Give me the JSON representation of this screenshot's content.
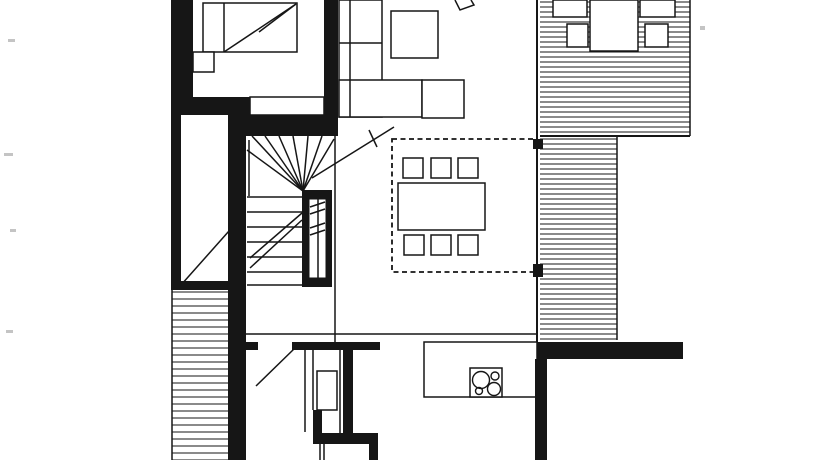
{
  "canvas": {
    "width": 840,
    "height": 460,
    "bg": "#ffffff",
    "ink": "#161616",
    "speck": "#c4c4c4"
  },
  "plan": {
    "hatches": [
      {
        "name": "deck-upper-hatch",
        "x": 540,
        "y": 0,
        "w": 150,
        "h": 134,
        "spacing": 5
      },
      {
        "name": "deck-strip-hatch",
        "x": 540,
        "y": 137,
        "w": 77,
        "h": 203,
        "spacing": 5
      },
      {
        "name": "deck-left-hatch",
        "x": 172,
        "y": 290,
        "w": 56,
        "h": 170,
        "spacing": 7
      }
    ],
    "furniture": [
      {
        "name": "deck-table",
        "x": 590,
        "y": 0,
        "w": 48,
        "h": 51
      },
      {
        "name": "deck-chair",
        "x": 553,
        "y": 0,
        "w": 34,
        "h": 17
      },
      {
        "name": "deck-chair",
        "x": 567,
        "y": 24,
        "w": 21,
        "h": 23
      },
      {
        "name": "deck-chair",
        "x": 640,
        "y": 0,
        "w": 35,
        "h": 17
      },
      {
        "name": "deck-chair",
        "x": 645,
        "y": 24,
        "w": 23,
        "h": 23
      },
      {
        "name": "bed",
        "x": 203,
        "y": 3,
        "w": 94,
        "h": 49
      },
      {
        "name": "nightstand",
        "x": 193,
        "y": 52,
        "w": 21,
        "h": 20
      },
      {
        "name": "wardrobe",
        "x": 250,
        "y": 97,
        "w": 74,
        "h": 18
      },
      {
        "name": "sofa-back",
        "x": 339,
        "y": 0,
        "w": 43,
        "h": 117
      },
      {
        "name": "sofa-seat",
        "x": 339,
        "y": 80,
        "w": 83,
        "h": 37
      },
      {
        "name": "sofa-end-table",
        "x": 422,
        "y": 80,
        "w": 42,
        "h": 38
      },
      {
        "name": "coffee-table",
        "x": 391,
        "y": 11,
        "w": 47,
        "h": 47
      },
      {
        "name": "dining-table",
        "x": 398,
        "y": 183,
        "w": 87,
        "h": 47
      },
      {
        "name": "dining-chair",
        "x": 403,
        "y": 158,
        "w": 20,
        "h": 20
      },
      {
        "name": "dining-chair",
        "x": 431,
        "y": 158,
        "w": 20,
        "h": 20
      },
      {
        "name": "dining-chair",
        "x": 458,
        "y": 158,
        "w": 20,
        "h": 20
      },
      {
        "name": "dining-chair",
        "x": 404,
        "y": 235,
        "w": 20,
        "h": 20
      },
      {
        "name": "dining-chair",
        "x": 431,
        "y": 235,
        "w": 20,
        "h": 20
      },
      {
        "name": "dining-chair",
        "x": 458,
        "y": 235,
        "w": 20,
        "h": 20
      },
      {
        "name": "kitchen-counter",
        "x": 424,
        "y": 342,
        "w": 113,
        "h": 55
      },
      {
        "name": "cooktop",
        "x": 470,
        "y": 368,
        "w": 32,
        "h": 29
      },
      {
        "name": "bath-fixture",
        "x": 317,
        "y": 371,
        "w": 20,
        "h": 39
      }
    ],
    "walls": [
      {
        "name": "wall-outer-left-top",
        "x": 171,
        "y": 0,
        "w": 22,
        "h": 115
      },
      {
        "name": "wall-bed-bottom",
        "x": 193,
        "y": 97,
        "w": 57,
        "h": 18
      },
      {
        "name": "wall-left-mid",
        "x": 171,
        "y": 115,
        "w": 10,
        "h": 172
      },
      {
        "name": "wall-stair-left",
        "x": 228,
        "y": 115,
        "w": 18,
        "h": 345
      },
      {
        "name": "wall-shaft-bottom",
        "x": 171,
        "y": 281,
        "w": 62,
        "h": 9
      },
      {
        "name": "wall-bedroom-living",
        "x": 324,
        "y": 0,
        "w": 14,
        "h": 136
      },
      {
        "name": "wall-stair-top",
        "x": 246,
        "y": 115,
        "w": 92,
        "h": 21
      },
      {
        "name": "flue-block",
        "x": 302,
        "y": 190,
        "w": 30,
        "h": 97
      },
      {
        "name": "window-pier-upper",
        "x": 533,
        "y": 139,
        "w": 10,
        "h": 10
      },
      {
        "name": "window-pier-lower",
        "x": 533,
        "y": 264,
        "w": 10,
        "h": 13
      },
      {
        "name": "wall-south-right",
        "x": 537,
        "y": 342,
        "w": 146,
        "h": 17
      },
      {
        "name": "wall-kitchen-right",
        "x": 535,
        "y": 359,
        "w": 12,
        "h": 101
      },
      {
        "name": "wall-hall-nub",
        "x": 246,
        "y": 342,
        "w": 12,
        "h": 8
      },
      {
        "name": "wall-bath-top",
        "x": 292,
        "y": 342,
        "w": 88,
        "h": 8
      },
      {
        "name": "wall-bath-right",
        "x": 343,
        "y": 350,
        "w": 10,
        "h": 87
      },
      {
        "name": "wall-bath-bottom",
        "x": 313,
        "y": 433,
        "w": 65,
        "h": 11
      },
      {
        "name": "wall-bath-left-stub",
        "x": 313,
        "y": 410,
        "w": 9,
        "h": 23
      },
      {
        "name": "wall-bottom-stub",
        "x": 369,
        "y": 444,
        "w": 9,
        "h": 16
      }
    ],
    "overlays": [
      {
        "name": "flue-inner",
        "x": 309,
        "y": 199,
        "w": 17,
        "h": 79
      }
    ],
    "lines": [
      {
        "name": "bed-divider",
        "p": [
          224,
          3,
          224,
          52
        ]
      },
      {
        "name": "bed-arrow-shaft",
        "p": [
          224,
          52,
          296,
          4
        ]
      },
      {
        "name": "bed-arrow-barb",
        "p": [
          259,
          32,
          296,
          4
        ]
      },
      {
        "name": "sofa-line-vertical",
        "p": [
          350,
          0,
          350,
          117
        ]
      },
      {
        "name": "sofa-line-horizontal",
        "p": [
          339,
          43,
          382,
          43
        ]
      },
      {
        "name": "window-wall",
        "p": [
          537,
          0,
          537,
          342
        ],
        "w": 2
      },
      {
        "name": "deck-right-edge",
        "p": [
          690,
          0,
          690,
          136
        ]
      },
      {
        "name": "deck-bottom-edge",
        "p": [
          540,
          136,
          690,
          136
        ],
        "w": 2
      },
      {
        "name": "deck-strip-right-edge",
        "p": [
          617,
          137,
          617,
          340
        ]
      },
      {
        "name": "deck-left-edge",
        "p": [
          172,
          290,
          172,
          460
        ]
      },
      {
        "name": "corridor-line",
        "p": [
          246,
          334,
          537,
          334
        ]
      },
      {
        "name": "stair-right-line",
        "p": [
          335,
          136,
          335,
          342
        ]
      },
      {
        "name": "shaft-diagonal",
        "p": [
          181,
          285,
          229,
          231
        ]
      },
      {
        "name": "stair-first-riser",
        "p": [
          249,
          140,
          249,
          196
        ]
      },
      {
        "name": "stair-fan-tread",
        "p": [
          303,
          191,
          247,
          150
        ]
      },
      {
        "name": "stair-fan-tread",
        "p": [
          303,
          191,
          252,
          136
        ]
      },
      {
        "name": "stair-fan-tread",
        "p": [
          303,
          191,
          265,
          136
        ]
      },
      {
        "name": "stair-fan-tread",
        "p": [
          303,
          191,
          279,
          136
        ]
      },
      {
        "name": "stair-fan-tread",
        "p": [
          303,
          191,
          293,
          136
        ]
      },
      {
        "name": "stair-fan-tread",
        "p": [
          303,
          191,
          308,
          136
        ]
      },
      {
        "name": "stair-fan-tread",
        "p": [
          303,
          191,
          322,
          136
        ]
      },
      {
        "name": "stair-fan-tread",
        "p": [
          303,
          191,
          334,
          139
        ]
      },
      {
        "name": "stair-tread",
        "p": [
          247,
          197,
          302,
          197
        ]
      },
      {
        "name": "stair-tread",
        "p": [
          247,
          212,
          302,
          212
        ]
      },
      {
        "name": "stair-tread",
        "p": [
          247,
          227,
          302,
          227
        ]
      },
      {
        "name": "stair-tread",
        "p": [
          247,
          242,
          302,
          242
        ]
      },
      {
        "name": "stair-tread",
        "p": [
          247,
          257,
          302,
          257
        ]
      },
      {
        "name": "stair-tread",
        "p": [
          247,
          272,
          302,
          272
        ]
      },
      {
        "name": "stair-tread",
        "p": [
          247,
          285,
          302,
          285
        ]
      },
      {
        "name": "stair-walkline",
        "p": [
          250,
          258,
          302,
          213
        ]
      },
      {
        "name": "stair-walkline",
        "p": [
          250,
          268,
          302,
          220
        ]
      },
      {
        "name": "flue-divider",
        "p": [
          318,
          199,
          318,
          278
        ]
      },
      {
        "name": "flue-tick",
        "p": [
          310,
          207,
          325,
          202
        ]
      },
      {
        "name": "flue-tick",
        "p": [
          310,
          214,
          325,
          209
        ]
      },
      {
        "name": "flue-tick",
        "p": [
          310,
          228,
          325,
          223
        ]
      },
      {
        "name": "flue-tick",
        "p": [
          310,
          235,
          325,
          230
        ]
      },
      {
        "name": "door-swing-upper",
        "p": [
          312,
          178,
          394,
          127
        ]
      },
      {
        "name": "door-swing-tick",
        "p": [
          369,
          130,
          377,
          147
        ]
      },
      {
        "name": "door-swing-lower",
        "p": [
          256,
          386,
          295,
          348
        ]
      },
      {
        "name": "bath-line-left",
        "p": [
          305,
          350,
          305,
          432
        ]
      },
      {
        "name": "bath-line-inner",
        "p": [
          313,
          350,
          313,
          410
        ]
      },
      {
        "name": "bath-line-right",
        "p": [
          340,
          350,
          340,
          433
        ]
      },
      {
        "name": "bottom-door-line",
        "p": [
          320,
          444,
          320,
          460
        ]
      },
      {
        "name": "bottom-door-line",
        "p": [
          324,
          444,
          324,
          460
        ]
      }
    ],
    "dashed": [
      {
        "name": "dining-zone-outline",
        "x": 392,
        "y": 139,
        "w": 145,
        "h": 133
      }
    ],
    "circles": [
      {
        "name": "cooktop-burner-large",
        "cx": 481,
        "cy": 380,
        "r": 8.5
      },
      {
        "name": "cooktop-burner-large",
        "cx": 494,
        "cy": 389,
        "r": 6.5
      },
      {
        "name": "cooktop-burner-small",
        "cx": 495,
        "cy": 376,
        "r": 4
      },
      {
        "name": "cooktop-burner-small",
        "cx": 479,
        "cy": 391,
        "r": 3.5
      }
    ],
    "polylines": [
      {
        "name": "lounge-chair-angled",
        "points": "455,0 460,10 474,5 471,0"
      }
    ],
    "specks": [
      {
        "x": 8,
        "y": 39,
        "w": 7,
        "h": 3
      },
      {
        "x": 4,
        "y": 153,
        "w": 9,
        "h": 3
      },
      {
        "x": 10,
        "y": 229,
        "w": 6,
        "h": 3
      },
      {
        "x": 6,
        "y": 330,
        "w": 7,
        "h": 3
      },
      {
        "x": 700,
        "y": 26,
        "w": 5,
        "h": 4
      }
    ]
  }
}
